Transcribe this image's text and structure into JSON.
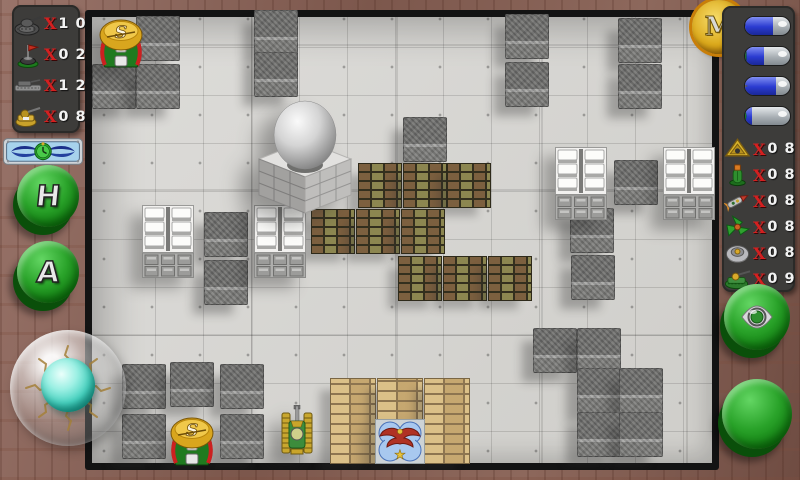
{
  "colors": {
    "accent_green": "#2aa32a",
    "gold": "#dba91b",
    "gauge_blue": "#2a3bd0",
    "x_red": "#d42020",
    "wood_brown": "#8d6a5e",
    "floor_gray": "#d7d6d3"
  },
  "left_panel": {
    "counters": [
      {
        "icon": "enemy-tank-icon",
        "prefix": "X",
        "value": "1 0"
      },
      {
        "icon": "flag-base-icon",
        "prefix": "X",
        "value": "0 2"
      },
      {
        "icon": "apc-icon",
        "prefix": "X",
        "value": "1 2"
      },
      {
        "icon": "gun-turret-icon",
        "prefix": "X",
        "value": "0 8"
      }
    ],
    "plaque_icon": "winged-clock",
    "buttons": [
      {
        "name": "h-button",
        "label": "H"
      },
      {
        "name": "a-button",
        "label": "A"
      }
    ],
    "joystick": "glass-trackball"
  },
  "right_panel": {
    "coin_label": "M",
    "weapon_gauges": [
      {
        "icon": "revolver-icon",
        "fill_percent": 62
      },
      {
        "icon": "medkit-icon",
        "fill_percent": 42
      },
      {
        "icon": "spike-mine-icon",
        "fill_percent": 68
      },
      {
        "icon": "target-icon",
        "fill_percent": 15
      }
    ],
    "counters": [
      {
        "icon": "triangle-device-icon",
        "prefix": "X",
        "value": "0 8"
      },
      {
        "icon": "grenade-icon",
        "prefix": "X",
        "value": "0 8"
      },
      {
        "icon": "rocket-icon",
        "prefix": "X",
        "value": "0 8"
      },
      {
        "icon": "tri-star-icon",
        "prefix": "X",
        "value": "0 8"
      },
      {
        "icon": "mine-disc-icon",
        "prefix": "X",
        "value": "0 8"
      },
      {
        "icon": "tank-icon",
        "prefix": "X",
        "value": "0 9"
      }
    ],
    "buttons": [
      {
        "name": "ring-button",
        "icon": "silver-ring-icon"
      },
      {
        "name": "fire-button",
        "icon": "none"
      }
    ]
  },
  "board": {
    "origin": {
      "x": 92,
      "y": 17
    },
    "tile_size": 48,
    "spawner_glyph": "S",
    "stone_blocks": [
      [
        136,
        16
      ],
      [
        92,
        64
      ],
      [
        136,
        64
      ],
      [
        254,
        10
      ],
      [
        254,
        52
      ],
      [
        505,
        14
      ],
      [
        505,
        62
      ],
      [
        618,
        18
      ],
      [
        618,
        64
      ],
      [
        403,
        117
      ],
      [
        614,
        160
      ],
      [
        570,
        208
      ],
      [
        571,
        255
      ],
      [
        204,
        212
      ],
      [
        204,
        260
      ],
      [
        533,
        328
      ],
      [
        577,
        328
      ],
      [
        577,
        368
      ],
      [
        619,
        368
      ],
      [
        577,
        412
      ],
      [
        619,
        412
      ],
      [
        122,
        364
      ],
      [
        170,
        362
      ],
      [
        220,
        364
      ],
      [
        122,
        414
      ],
      [
        220,
        414
      ]
    ],
    "olive_bricks": [
      [
        358,
        163
      ],
      [
        403,
        163
      ],
      [
        447,
        163
      ],
      [
        311,
        209
      ],
      [
        356,
        209
      ],
      [
        401,
        209
      ],
      [
        398,
        256
      ],
      [
        443,
        256
      ],
      [
        488,
        256
      ]
    ],
    "white_bunkers": [
      [
        142,
        205
      ],
      [
        254,
        205
      ],
      [
        555,
        147
      ],
      [
        663,
        147
      ]
    ],
    "tan_walls": [
      [
        330,
        378,
        46,
        86
      ],
      [
        377,
        378,
        46,
        43
      ],
      [
        424,
        378,
        46,
        86
      ]
    ],
    "spawners": [
      [
        95,
        16
      ],
      [
        166,
        414
      ]
    ],
    "dome": [
      257,
      95
    ],
    "player_tank": [
      281,
      405
    ],
    "eagle_base": [
      375,
      419
    ]
  }
}
